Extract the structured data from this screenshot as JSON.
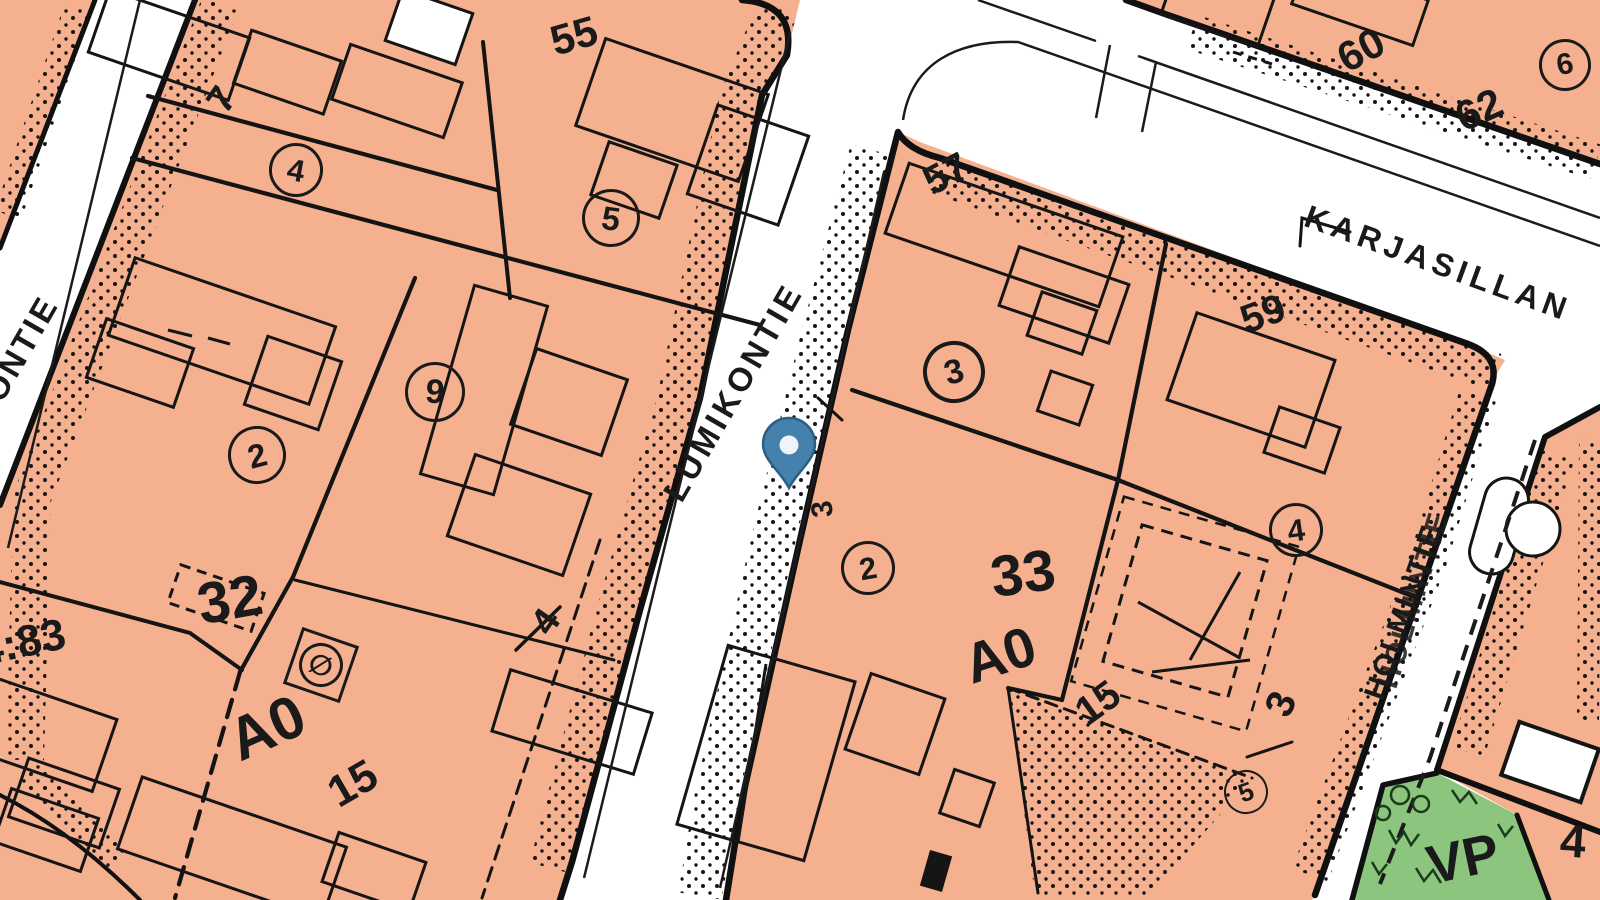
{
  "map_type": "cadastral-zoning-map",
  "colors": {
    "parcel_fill": "#f5b18f",
    "park_fill": "#8cc57d",
    "ink": "#1a1a1a",
    "pin_fill": "#4481ac",
    "pin_stroke": "#2b5e83",
    "road": "#ffffff"
  },
  "marker": {
    "kind": "location-pin",
    "color": "#4481ac"
  },
  "labels": {
    "street_lumikontie": "LUMIKONTIE",
    "street_kontie": "KONTIE",
    "street_karjasillan": "KARJASILLAN",
    "street_holmintie": "HOLMINTIE",
    "p7": "7",
    "p55": "55",
    "p57": "57",
    "p59": "59",
    "p60": "60",
    "p62": "62",
    "p4_west": "4",
    "p3_east": "3",
    "p3_small": "3",
    "p4_corner": "4",
    "p483": "4:83",
    "block32": "32",
    "block33": "33",
    "a0_west": "A0",
    "a0_east": "A0",
    "e15_west": "15",
    "e15_east": "15",
    "vp": "VP",
    "c4_west": "4",
    "c5_west": "5",
    "c9": "9",
    "c2_west": "2",
    "c3": "3",
    "c2_mid": "2",
    "c4_east": "4",
    "c5_east": "5",
    "c6": "6",
    "symbol_o": "∅"
  }
}
